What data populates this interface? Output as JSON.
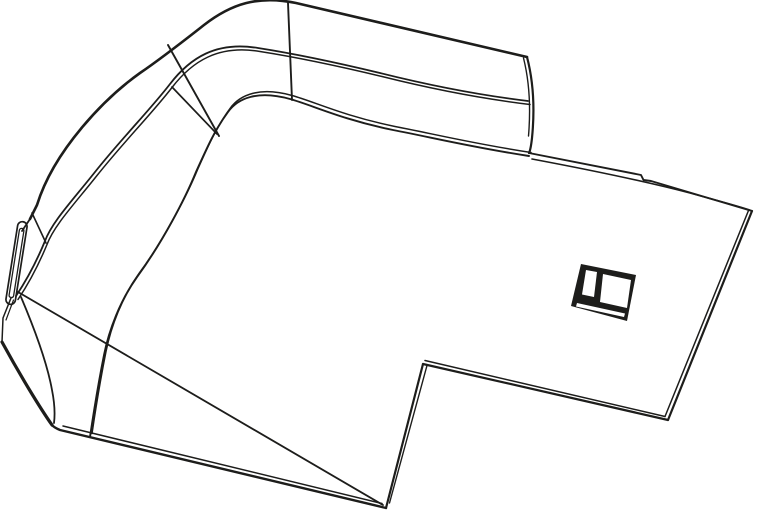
{
  "meta": {
    "title": "Isometric technical line drawing of a molded cover part with curved side wall, side slot, latch hole and notched bottom edge",
    "canvas_width": 759,
    "canvas_height": 514,
    "background_color": "#ffffff",
    "stroke_color": "#1d1d1b"
  },
  "figure": {
    "parts": [
      {
        "name": "wall-top-outer-edge",
        "strokes": [
          {
            "d": "M527 57 L296 3 C258 -5 231 4 204 25 C181 43 162 58 140 73 C105 98 54 150 37 205 L30 219",
            "w": 2.6
          }
        ]
      },
      {
        "name": "wall-end-fork-lines",
        "strokes": [
          {
            "d": "M30 219 L22 231",
            "w": 1.8
          },
          {
            "d": "M32 213 L46 243",
            "w": 1.6
          }
        ]
      },
      {
        "name": "wall-rim-edge-pair",
        "strokes": [
          {
            "d": "M528 101 C470 94 420 83 380 73 C330 61 290 53 258 48 C216 41 190 58 170 84 C150 110 122 138 95 172 C72 201 52 222 45 241 C38 258 28 278 16 296",
            "w": 1.8
          },
          {
            "d": "M528 101 C470 94 420 83 380 73 C330 61 290 53 258 48 C216 41 190 58 170 84 C150 110 122 138 95 172 C72 201 52 222 45 241 C38 258 28 278 16 296",
            "w": 1.5,
            "t": "translate(2,3.5)"
          }
        ]
      },
      {
        "name": "corner-seam-lines",
        "strokes": [
          {
            "d": "M288 3 L292 100",
            "w": 1.9
          },
          {
            "d": "M168 45 L219 136",
            "w": 1.9
          },
          {
            "d": "M172 87 L217 134",
            "w": 1.7
          }
        ]
      },
      {
        "name": "wall-base-edge-pair",
        "strokes": [
          {
            "d": "M529 156 C470 147 430 137 393 130 C340 119 312 105 290 99 C258 90 238 98 228 112 C214 131 206 150 196 172 C185 199 162 243 137 277 C120 301 109 330 104 355 C99 380 94 410 90 437",
            "w": 1.9
          },
          {
            "d": "M529 156 C470 147 430 137 393 130 C340 119 312 105 290 99 C258 90 238 98 228 112 C214 131 206 150 196 172 C185 199 162 243 137 277 C120 301 109 330 104 355 C99 380 94 410 90 437",
            "w": 1.5,
            "t": "translate(2,-3.5)"
          }
        ]
      },
      {
        "name": "wall-tab-right-edge",
        "strokes": [
          {
            "d": "M527 57 C533 80 535 108 532 138 C531 147 530 151 529 153",
            "w": 2.2
          },
          {
            "d": "M523.5 58 C529 80 531 106 528.5 136",
            "w": 1.4
          }
        ]
      },
      {
        "name": "sheet-top-right-edge-pair",
        "strokes": [
          {
            "d": "M529 153 L641 175 L643.5 180 L651 181 L752 211",
            "w": 1.9
          },
          {
            "d": "M532 159 C580 168 640 180 690 193 C715 200 738 206 751 210.5",
            "w": 1.6
          }
        ]
      },
      {
        "name": "sheet-right-edge-pair",
        "strokes": [
          {
            "d": "M752 211 L668 420",
            "w": 2.2
          },
          {
            "d": "M748.5 210.5 L665 416.5",
            "w": 1.5
          }
        ]
      },
      {
        "name": "sheet-bottom-right-edge-pair",
        "strokes": [
          {
            "d": "M668 420 L423 364",
            "w": 2.2
          },
          {
            "d": "M665 416.5 L425 360.5",
            "w": 1.5
          }
        ]
      },
      {
        "name": "notch-edge-pair",
        "strokes": [
          {
            "d": "M423 364 L386 508",
            "w": 2.2
          },
          {
            "d": "M427 365.5 L389.5 503",
            "w": 1.4
          }
        ]
      },
      {
        "name": "sheet-bottom-left-edge-pair",
        "strokes": [
          {
            "d": "M386 508 L60 430 Q54 427.5 52 425",
            "w": 2.4
          },
          {
            "d": "M382 503.5 L63 426",
            "w": 1.5
          }
        ]
      },
      {
        "name": "sheet-left-corner-edge",
        "strokes": [
          {
            "d": "M2 342 C20 375 40 408 52 425",
            "w": 3.2
          }
        ]
      },
      {
        "name": "wall-end-face-lines",
        "strokes": [
          {
            "d": "M11 298 L3 318 L2 342",
            "w": 1.5
          },
          {
            "d": "M13.5 300 L6 320",
            "w": 1.2
          }
        ]
      },
      {
        "name": "sheet-crease-line",
        "strokes": [
          {
            "d": "M18 292 L383 505",
            "w": 1.8
          }
        ]
      },
      {
        "name": "apron-base-line",
        "strokes": [
          {
            "d": "M21 297 C35 330 47 362 52 390 C55 405 55 415 54 423",
            "w": 1.8
          }
        ]
      },
      {
        "name": "side-slot-outer",
        "strokes": [
          {
            "d": "M27 227.2 L15.4 300.3 A4.75 4.75 0 0 1 6 298.9 L17.6 225.7 A4.75 4.75 0 0 1 27 227.2 Z",
            "w": 1.7
          }
        ]
      },
      {
        "name": "side-slot-inner",
        "strokes": [
          {
            "d": "M23.9 230.8 L13.6 295.9 A2.3 2.3 0 0 1 9.1 295.2 L19.4 230 A2.3 2.3 0 0 1 23.9 230.8 Z",
            "w": 1.3
          }
        ]
      },
      {
        "name": "latch-hole-frame",
        "strokes": [
          {
            "d": "M581 264 L636 275 L627 321 L571 306 Z",
            "fill": "#1d1d1b"
          }
        ]
      },
      {
        "name": "latch-hole-left-window",
        "strokes": [
          {
            "d": "M586 270 L597 272 L594 297 L582 294.5 Z",
            "fill": "#ffffff"
          }
        ]
      },
      {
        "name": "latch-hole-right-window",
        "strokes": [
          {
            "d": "M603 274 L631 280 L627 308 L600 302 Z",
            "fill": "#ffffff"
          }
        ]
      },
      {
        "name": "latch-hole-bottom-strip",
        "strokes": [
          {
            "d": "M577 303 L625 313.5 L624 317 L576 306.5 Z",
            "fill": "#ffffff"
          }
        ]
      }
    ]
  }
}
